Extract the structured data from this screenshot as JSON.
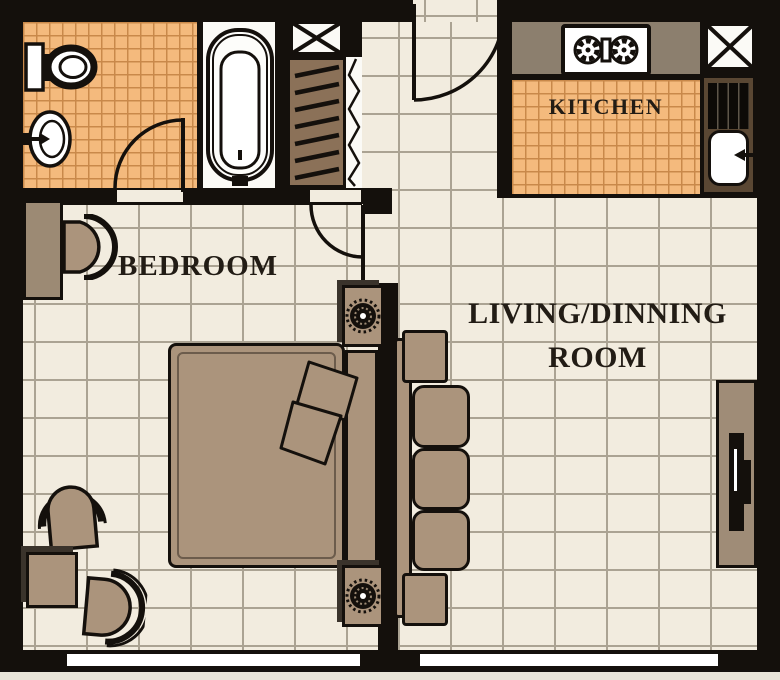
{
  "plan": {
    "labels": {
      "bedroom": "BEDROOM",
      "living_line1": "LIVING/DINNING",
      "living_line2": "ROOM",
      "kitchen": "KITCHEN"
    },
    "colors": {
      "wall": "#14100c",
      "floor": "#f2ecdf",
      "floor_line": "#aba393",
      "wet_floor": "#f4ba7d",
      "wet_floor_line": "#c9894a",
      "furniture": "#ab947c",
      "closet": "#8b7158",
      "counter": "#8c7f6e",
      "label_text": "#221c15"
    },
    "fixtures": [
      "toilet",
      "wash-basin",
      "bathtub",
      "wardrobe-closet",
      "folding-door",
      "structural-column",
      "entry-door",
      "bathroom-door",
      "bedroom-door",
      "stove-cooktop",
      "kitchen-sink",
      "double-bed",
      "pillows",
      "nightstand-with-lamp",
      "armchair",
      "side-table",
      "desk",
      "sofa",
      "tv-unit",
      "window"
    ]
  }
}
